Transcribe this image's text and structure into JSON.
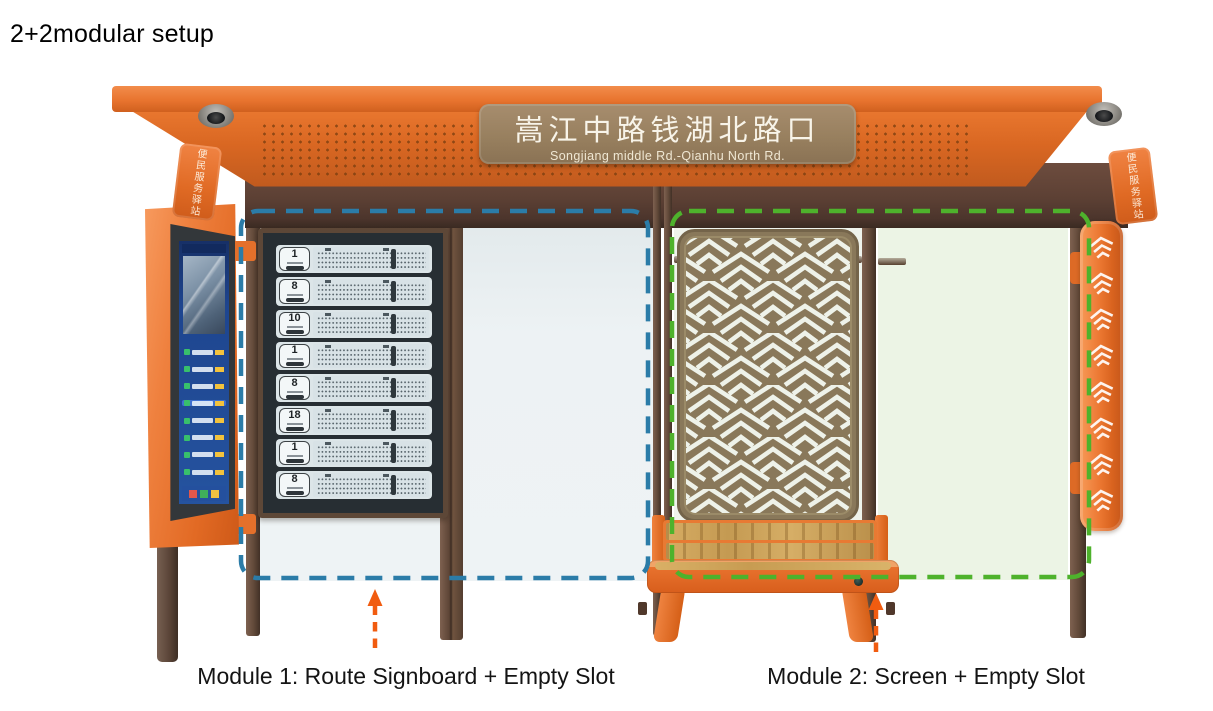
{
  "title": "2+2modular setup",
  "shelter": {
    "station_sign": {
      "name_zh": "嵩江中路钱湖北路口",
      "name_en": "Songjiang middle Rd.-Qianhu North Rd."
    },
    "service_sign_left": "便民服务驿站",
    "service_sign_right": "便民服务驿站"
  },
  "route_signboard": {
    "routes": [
      "1",
      "8",
      "10",
      "1",
      "8",
      "18",
      "1",
      "8"
    ]
  },
  "kiosk_screen": {
    "list_rows": 8,
    "highlighted_row": 4
  },
  "side_panel": {
    "chevron_count": 8
  },
  "modules": {
    "module1": {
      "label": "Module 1: Route Signboard + Empty Slot",
      "outline_color": "#2b7ca8"
    },
    "module2": {
      "label": "Module 2: Screen + Empty Slot",
      "outline_color": "#4eb22c"
    }
  },
  "annotations": {
    "arrow_color": "#f15c10"
  }
}
